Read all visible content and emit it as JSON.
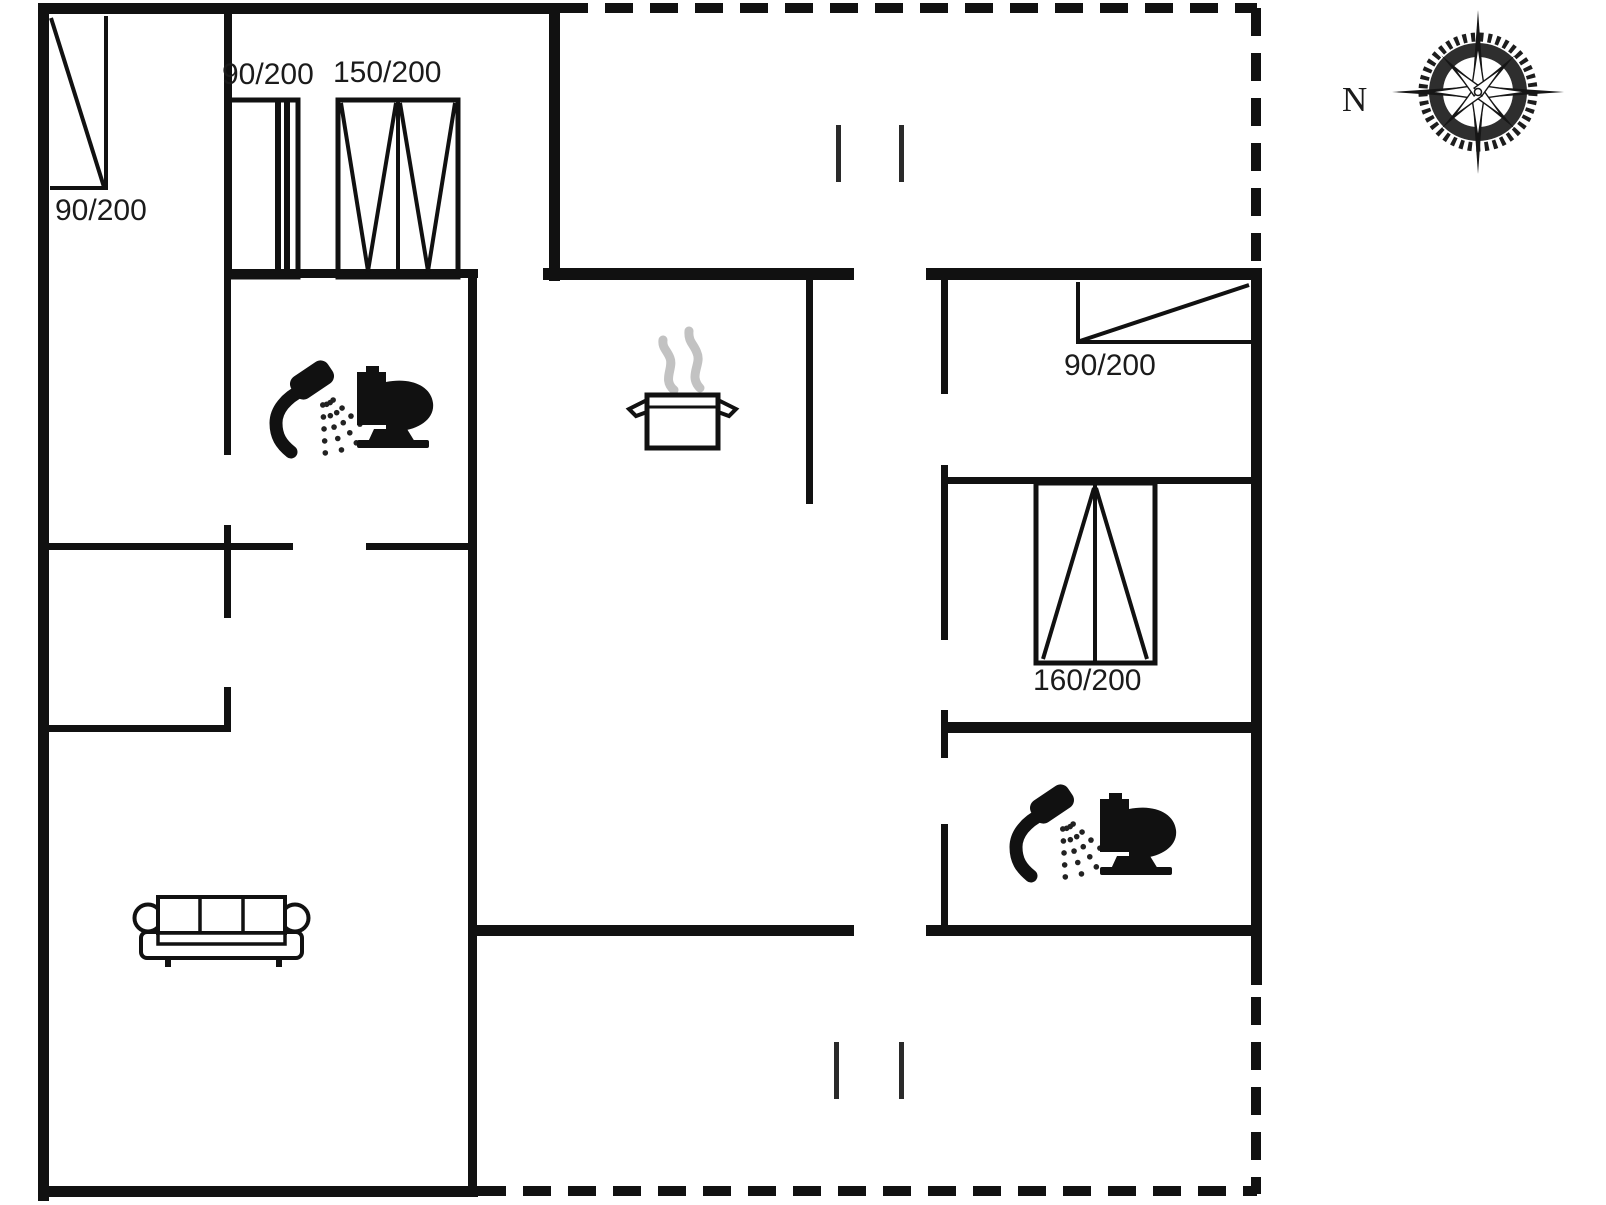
{
  "page": {
    "background": "#ffffff",
    "ink": "#111111",
    "steam_color": "#c2c2c2",
    "width": 1606,
    "height": 1205
  },
  "compass": {
    "label": "N",
    "cx": 1478,
    "cy": 92
  },
  "labels": [
    {
      "id": "dim-window-left-bedroom",
      "text": "90/200",
      "x": 55,
      "y": 196,
      "size": 30,
      "serif": false
    },
    {
      "id": "dim-closet-sliding",
      "text": "90/200",
      "x": 222,
      "y": 60,
      "size": 30,
      "serif": false
    },
    {
      "id": "dim-closet-hinged",
      "text": "150/200",
      "x": 333,
      "y": 58,
      "size": 30,
      "serif": false
    },
    {
      "id": "dim-window-right-bedroom",
      "text": "90/200",
      "x": 1064,
      "y": 351,
      "size": 30,
      "serif": false
    },
    {
      "id": "dim-wardrobe-right",
      "text": "160/200",
      "x": 1033,
      "y": 666,
      "size": 30,
      "serif": false
    },
    {
      "id": "compass-north-label",
      "text": "N",
      "x": 1342,
      "y": 82,
      "size": 35,
      "serif": true
    }
  ],
  "walls": [
    {
      "x": 38,
      "y": 3,
      "w": 11,
      "h": 1198
    },
    {
      "x": 38,
      "y": 3,
      "w": 522,
      "h": 11
    },
    {
      "x": 549,
      "y": 3,
      "w": 11,
      "h": 278
    },
    {
      "x": 224,
      "y": 10,
      "w": 8,
      "h": 266
    },
    {
      "x": 224,
      "y": 269,
      "w": 254,
      "h": 9
    },
    {
      "x": 543,
      "y": 268,
      "w": 311,
      "h": 12
    },
    {
      "x": 926,
      "y": 268,
      "w": 336,
      "h": 12
    },
    {
      "x": 1251,
      "y": 268,
      "w": 11,
      "h": 717
    },
    {
      "x": 806,
      "y": 280,
      "w": 7,
      "h": 224
    },
    {
      "x": 941,
      "y": 280,
      "w": 7,
      "h": 114
    },
    {
      "x": 941,
      "y": 477,
      "w": 311,
      "h": 7
    },
    {
      "x": 941,
      "y": 465,
      "w": 7,
      "h": 175
    },
    {
      "x": 941,
      "y": 710,
      "w": 7,
      "h": 48
    },
    {
      "x": 941,
      "y": 824,
      "w": 7,
      "h": 103
    },
    {
      "x": 941,
      "y": 722,
      "w": 321,
      "h": 11
    },
    {
      "x": 926,
      "y": 925,
      "w": 336,
      "h": 11
    },
    {
      "x": 468,
      "y": 925,
      "w": 386,
      "h": 11
    },
    {
      "x": 468,
      "y": 276,
      "w": 9,
      "h": 921
    },
    {
      "x": 38,
      "y": 1186,
      "w": 440,
      "h": 11
    },
    {
      "x": 44,
      "y": 543,
      "w": 249,
      "h": 7
    },
    {
      "x": 366,
      "y": 543,
      "w": 106,
      "h": 7
    },
    {
      "x": 224,
      "y": 278,
      "w": 7,
      "h": 177
    },
    {
      "x": 224,
      "y": 525,
      "w": 7,
      "h": 93
    },
    {
      "x": 224,
      "y": 687,
      "w": 7,
      "h": 45
    },
    {
      "x": 44,
      "y": 725,
      "w": 187,
      "h": 7
    }
  ],
  "dashed_lines": [
    {
      "x1": 560,
      "y1": 8,
      "x2": 1257,
      "y2": 8
    },
    {
      "x1": 1256,
      "y1": 8,
      "x2": 1256,
      "y2": 262
    },
    {
      "x1": 1256,
      "y1": 997,
      "x2": 1256,
      "y2": 1194
    },
    {
      "x1": 478,
      "y1": 1191,
      "x2": 1257,
      "y2": 1191
    }
  ],
  "windows": [
    {
      "name": "window-90x200-left",
      "frame": [
        [
          106,
          16,
          106,
          190
        ],
        [
          50,
          188,
          106,
          188
        ]
      ],
      "diagonal": [
        51,
        18,
        104,
        187
      ]
    },
    {
      "name": "window-90x200-right",
      "frame": [
        [
          1078,
          282,
          1078,
          344
        ],
        [
          1078,
          342,
          1251,
          342
        ]
      ],
      "diagonal": [
        1080,
        341,
        1249,
        285
      ]
    }
  ],
  "wardrobes": [
    {
      "name": "closet-90x200",
      "rect": [
        227,
        100,
        71,
        177
      ],
      "bars": [
        [
          275,
          102,
          6,
          173
        ],
        [
          284,
          102,
          6,
          173
        ]
      ],
      "lines": []
    },
    {
      "name": "closet-150x200",
      "rect": [
        338,
        100,
        120,
        177
      ],
      "bars": [],
      "lines": [
        [
          398,
          102,
          398,
          275
        ],
        [
          341,
          103,
          368,
          271
        ],
        [
          396,
          103,
          368,
          271
        ],
        [
          400,
          103,
          428,
          271
        ],
        [
          455,
          103,
          428,
          271
        ]
      ]
    },
    {
      "name": "wardrobe-160x200",
      "rect": [
        1036,
        483,
        119,
        180
      ],
      "bars": [],
      "lines": [
        [
          1095,
          485,
          1095,
          661
        ],
        [
          1043,
          659,
          1094,
          488
        ],
        [
          1096,
          488,
          1147,
          659
        ]
      ]
    }
  ],
  "door_markers": [
    {
      "x": 836,
      "y": 125,
      "h": 57
    },
    {
      "x": 899,
      "y": 125,
      "h": 57
    },
    {
      "x": 834,
      "y": 1042,
      "h": 57
    },
    {
      "x": 899,
      "y": 1042,
      "h": 57
    }
  ],
  "icons": [
    {
      "name": "shower-icon",
      "x": 266,
      "y": 366
    },
    {
      "name": "toilet-icon",
      "x": 357,
      "y": 366
    },
    {
      "name": "cooking-pot-icon",
      "x": 612,
      "y": 318
    },
    {
      "name": "sofa-icon",
      "x": 133,
      "y": 892
    },
    {
      "name": "shower-icon",
      "x": 1006,
      "y": 790
    },
    {
      "name": "toilet-icon",
      "x": 1100,
      "y": 793
    },
    {
      "name": "compass-rose-icon",
      "x": 1478,
      "y": 92
    }
  ]
}
